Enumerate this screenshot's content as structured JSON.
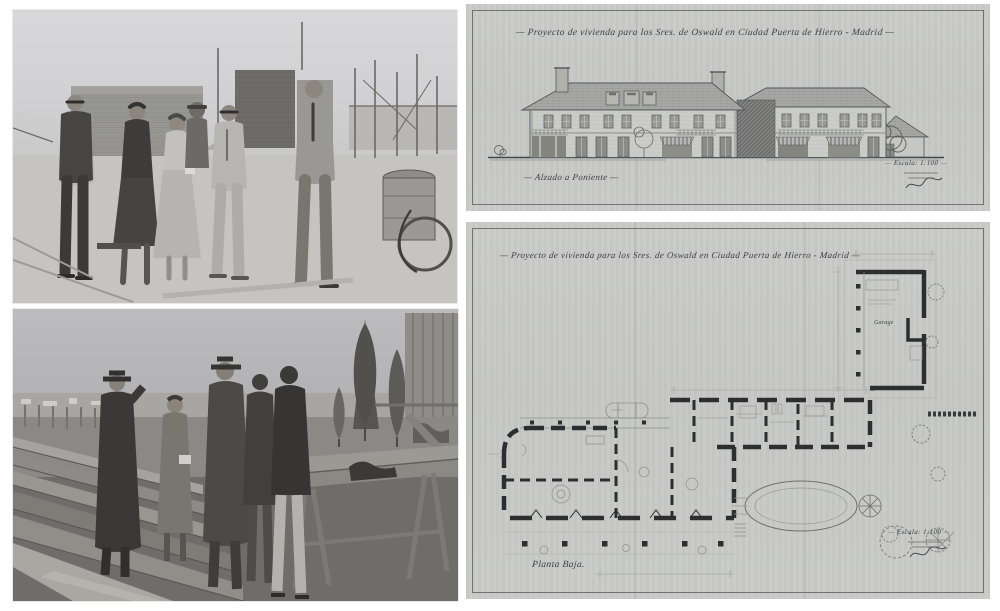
{
  "page": {
    "background": "#ffffff",
    "description": "Four-image collage: two black-and-white construction-site photographs on the left and two scanned hand-drawn architectural sheets on the right"
  },
  "photos": {
    "construction_site": {
      "alt": "Black-and-white photograph of six people in suits and dresses standing on the concrete roof slab of a house under construction, with brick walls, wooden scaffolding poles and a tar barrel on a wheeled cart at right"
    },
    "lumber_yard": {
      "alt": "Black-and-white photograph of five people in hats and overcoats talking beside stacks of lumber planks, with a work bench, young conifer trees and a wooden shed at right"
    }
  },
  "sheets": {
    "elevation": {
      "title": "— Proyecto de vivienda para los Sres. de Oswald en Ciudad Puerta de Hierro - Madrid —",
      "caption": "— Alzado a Poniente —",
      "scale_note": "— Escala: 1:100 —",
      "alt": "Scanned ink drawing: west elevation of a long two-storey house with hipped tiled roofs, dormers, chimneys, awnings and a lower service wing at right"
    },
    "plan": {
      "title": "— Proyecto de vivienda para los Sres. de Oswald en Ciudad Puerta de Hierro - Madrid —",
      "caption": "Planta Baja.",
      "scale_note": "— Escala: 1:100 —",
      "room_label": "Garage",
      "alt": "Scanned ink drawing: ground-floor plan with thick poché walls, a garage courtyard wing at upper right, a long central room band, a lower left wing with a post terrace, an oval patio and scribbled trees"
    }
  },
  "colors": {
    "paper": "#c9cac8",
    "ink": "#3c3e44",
    "wall_poche": "#2d2e30",
    "photo_sky_light": "#d9d9db",
    "photo_sky_dark": "#bcbcbe",
    "photo_shadow": "#2e2e2c"
  }
}
